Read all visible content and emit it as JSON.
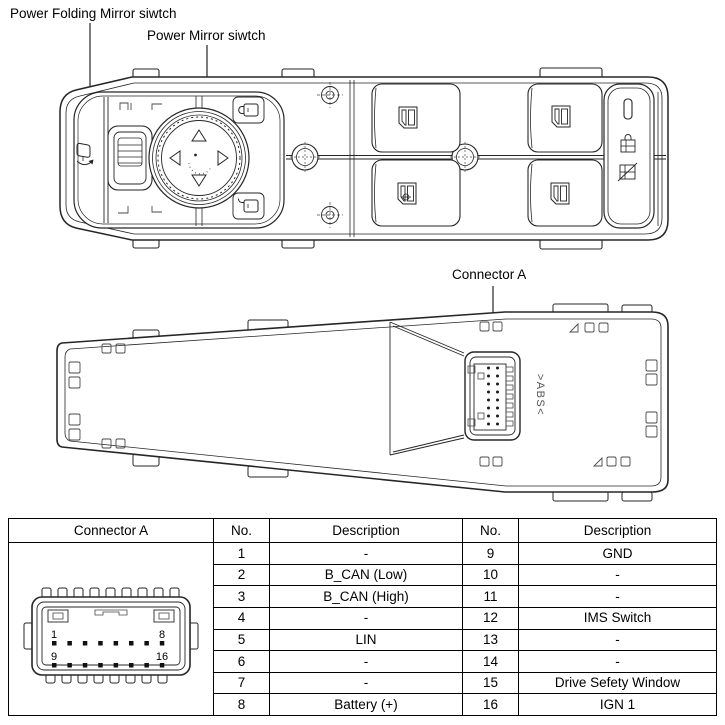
{
  "labels": {
    "power_folding_mirror": "Power Folding Mirror siwtch",
    "power_mirror": "Power Mirror siwtch",
    "connector_a": "Connector A",
    "abs_marking": ">ABS<"
  },
  "connector_front": {
    "pin1": "1",
    "pin8": "8",
    "pin9": "9",
    "pin16": "16"
  },
  "table": {
    "headers": {
      "connector": "Connector A",
      "no": "No.",
      "description": "Description"
    },
    "rows": [
      {
        "no_l": "1",
        "desc_l": "-",
        "no_r": "9",
        "desc_r": "GND"
      },
      {
        "no_l": "2",
        "desc_l": "B_CAN (Low)",
        "no_r": "10",
        "desc_r": "-"
      },
      {
        "no_l": "3",
        "desc_l": "B_CAN (High)",
        "no_r": "11",
        "desc_r": "-"
      },
      {
        "no_l": "4",
        "desc_l": "-",
        "no_r": "12",
        "desc_r": "IMS Switch"
      },
      {
        "no_l": "5",
        "desc_l": "LIN",
        "no_r": "13",
        "desc_r": "-"
      },
      {
        "no_l": "6",
        "desc_l": "-",
        "no_r": "14",
        "desc_r": "-"
      },
      {
        "no_l": "7",
        "desc_l": "-",
        "no_r": "15",
        "desc_r": "Drive Sefety Window"
      },
      {
        "no_l": "8",
        "desc_l": "Battery (+)",
        "no_r": "16",
        "desc_r": "IGN 1"
      }
    ]
  }
}
